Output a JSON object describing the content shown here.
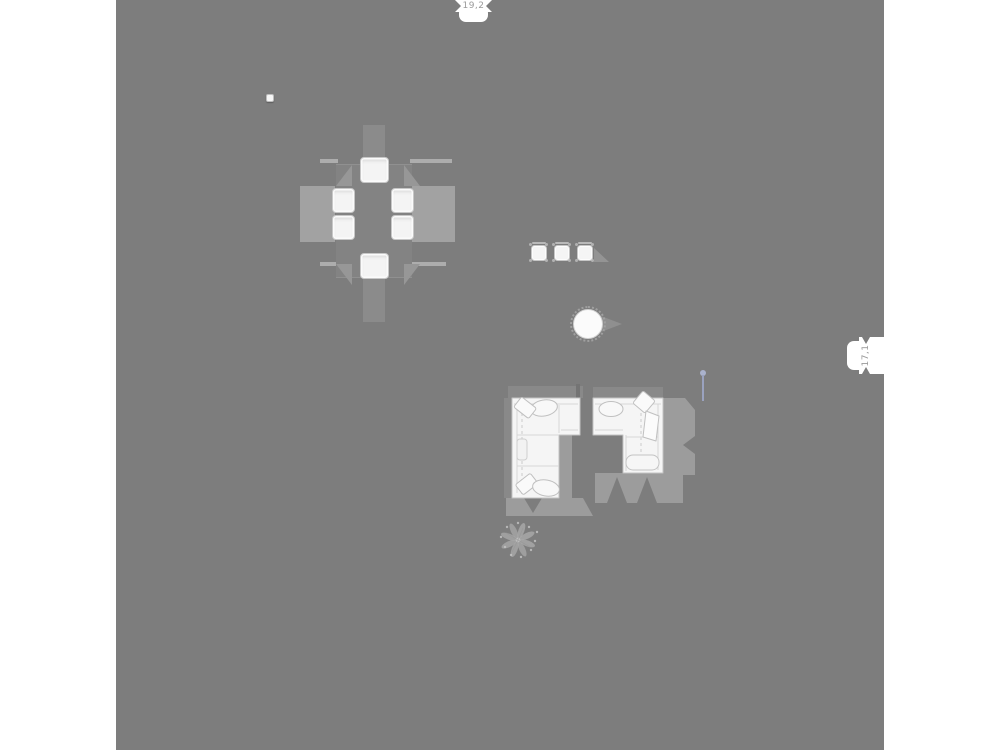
{
  "plan": {
    "dimension_labels": {
      "top": "19,2",
      "right": "17,1"
    },
    "furniture": {
      "dining_set": "dining-table-with-6-chairs",
      "bar_stools": "three-bar-stools",
      "round_table": "round-side-table",
      "sofa_left": "l-shaped-sofa-left",
      "sofa_right": "l-shaped-sofa-right",
      "console": "console-between-sofas",
      "floor_lamp": "floor-lamp",
      "plant": "potted-plant",
      "marker": "small-marker-dot"
    }
  },
  "colors": {
    "page_bg": "#ffffff",
    "canvas_bg": "#7d7d7d",
    "shadow": "#9c9c9c",
    "shadow_light": "#a2a2a2",
    "shadow_soft": "#8b8b8b",
    "furniture_white": "#f5f5f5",
    "furniture_outline": "#c2c2c2",
    "label_text": "#9b9b9b",
    "lamp_accent": "#9aa2bf"
  }
}
